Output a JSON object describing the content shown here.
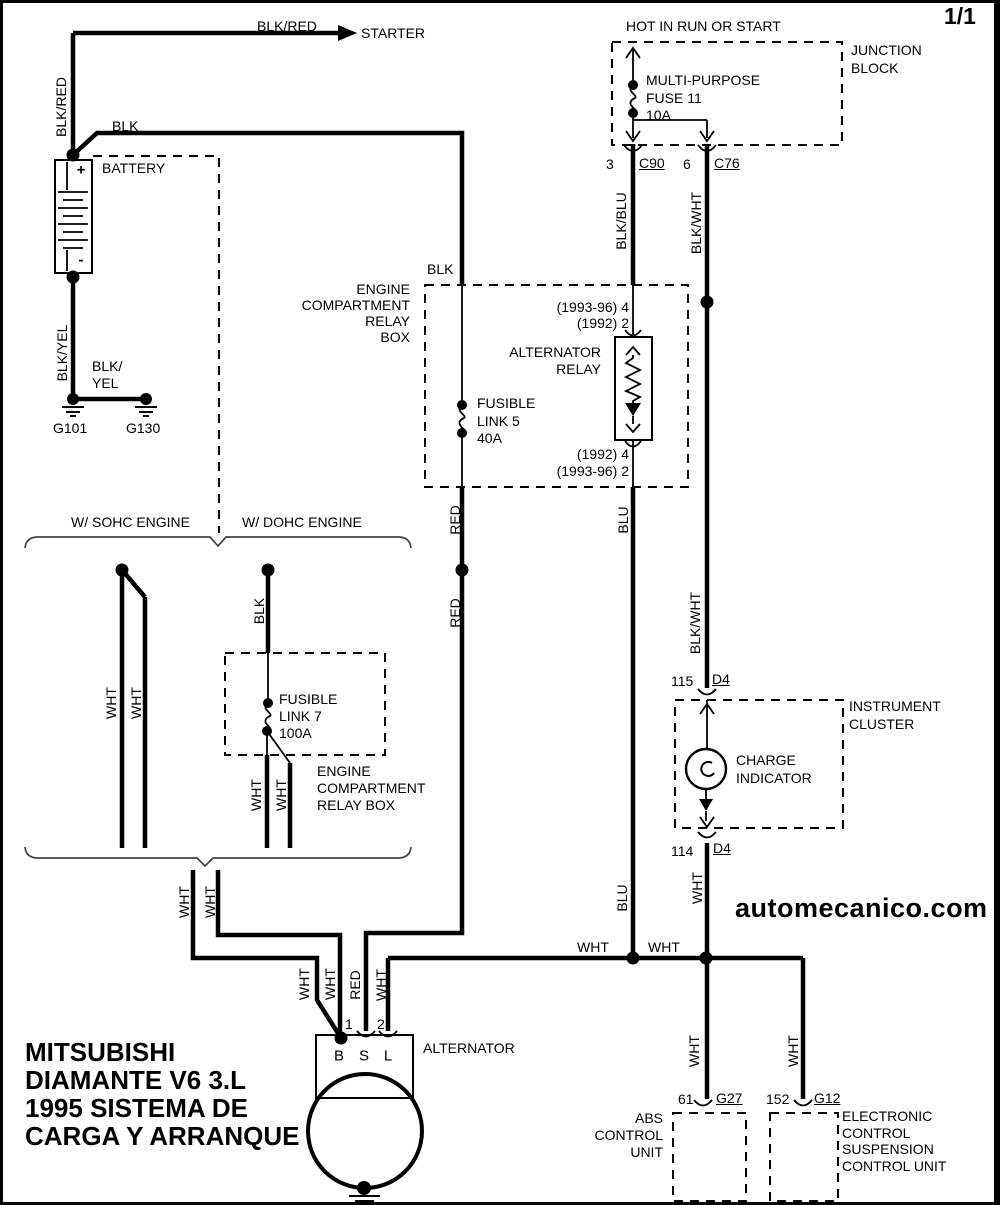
{
  "page_number": "1/1",
  "watermark": "automecanico.com",
  "title_block": "MITSUBISHI\nDIAMANTE V6 3.L\n1995 SISTEMA DE\nCARGA Y ARRANQUE",
  "starter_circuit": {
    "feed_wire": "BLK/RED",
    "target": "STARTER",
    "vertical_wire": "BLK/RED",
    "to_relaybox_wire": "BLK"
  },
  "battery": {
    "label": "BATTERY",
    "plus": "+",
    "minus": "-"
  },
  "ground_circuit": {
    "vertical_wire": "BLK/YEL",
    "link_wire": "BLK/\nYEL",
    "g101": "G101",
    "g130": "G130"
  },
  "junction_block": {
    "header": "HOT IN RUN OR START",
    "label": "JUNCTION\nBLOCK",
    "fuse_label": "MULTI-PURPOSE\nFUSE 11\n10A",
    "pin3": "3",
    "c90": "C90",
    "pin6": "6",
    "c76": "C76",
    "out_left_wire": "BLK/BLU",
    "out_right_wire": "BLK/WHT"
  },
  "relay_box": {
    "label": "ENGINE\nCOMPARTMENT\nRELAY\nBOX",
    "entry_wire": "BLK",
    "fusible_link": "FUSIBLE\nLINK 5\n40A",
    "relay_label": "ALTERNATOR\nRELAY",
    "pins_top": "(1993-96) 4\n(1992) 2",
    "pins_bottom": "(1992) 4\n(1993-96) 2"
  },
  "mid_wires": {
    "red_upper": "RED",
    "red_lower": "RED",
    "blu_upper": "BLU",
    "blu_lower": "BLU",
    "blk_wht_mid": "BLK/WHT",
    "cluster_out": "WHT",
    "bus_wht_left": "WHT",
    "bus_wht_right": "WHT"
  },
  "engine_variants": {
    "sohc": "W/ SOHC ENGINE",
    "dohc": "W/ DOHC ENGINE",
    "sohc_wht1": "WHT",
    "sohc_wht2": "WHT",
    "dohc_blk": "BLK",
    "fusible_link": "FUSIBLE\nLINK 7\n100A",
    "relay_box_label": "ENGINE\nCOMPARTMENT\nRELAY BOX",
    "dohc_wht1": "WHT",
    "dohc_wht2": "WHT",
    "merged_wht1": "WHT",
    "merged_wht2": "WHT"
  },
  "instrument_cluster": {
    "label": "INSTRUMENT\nCLUSTER",
    "pin115": "115",
    "d4_top": "D4",
    "lamp_label": "CHARGE\nINDICATOR",
    "pin114": "114",
    "d4_bottom": "D4"
  },
  "alternator": {
    "label": "ALTERNATOR",
    "b": "B",
    "s": "S",
    "l": "L",
    "pin1": "1",
    "pin2": "2",
    "wht_b1": "WHT",
    "wht_b2": "WHT",
    "red_s": "RED",
    "wht_l": "WHT"
  },
  "abs_unit": {
    "pin": "61",
    "conn": "G27",
    "wire": "WHT",
    "label": "ABS\nCONTROL\nUNIT"
  },
  "ecs_unit": {
    "pin": "152",
    "conn": "G12",
    "wire": "WHT",
    "label": "ELECTRONIC\nCONTROL\nSUSPENSION\nCONTROL UNIT"
  },
  "colors": {
    "line": "#000000",
    "background": "#ffffff",
    "brace": "#444444"
  }
}
